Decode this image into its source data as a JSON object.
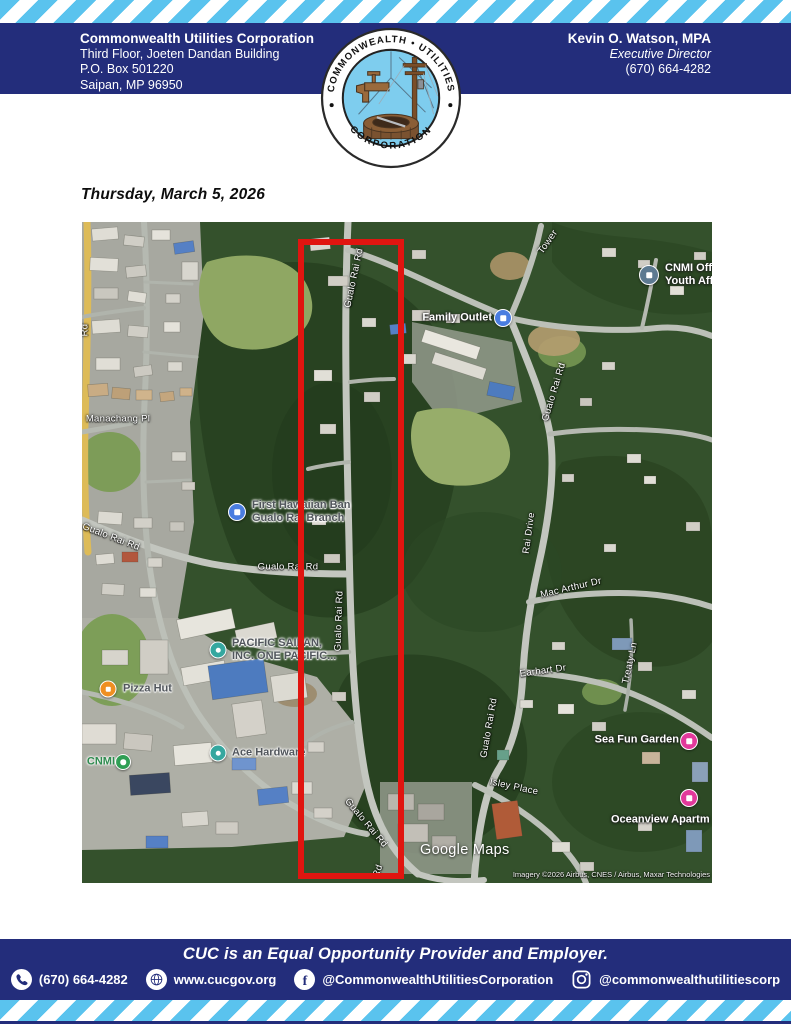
{
  "page": {
    "colors": {
      "navy": "#232d7b",
      "stripe_blue": "#5ac3ee",
      "highlight_red": "#e01510"
    }
  },
  "header": {
    "org_name": "Commonwealth Utilities Corporation",
    "address_lines": [
      "Third Floor, Joeten Dandan Building",
      "P.O. Box 501220",
      "Saipan, MP 96950"
    ],
    "director": {
      "name": "Kevin O. Watson, MPA",
      "title": "Executive Director",
      "phone": "(670) 664-4282"
    }
  },
  "logo": {
    "arc_top": "COMMONWEALTH • UTILITIES",
    "arc_bottom": "CORPORATION"
  },
  "date_line": "Thursday, March 5, 2026",
  "map": {
    "watermark": "Google Maps",
    "attribution": "Imagery ©2026 Airbus, CNES / Airbus, Maxar Technologies",
    "highlight": {
      "x": 216,
      "y": 17,
      "width": 94,
      "height": 628,
      "color": "#e01510"
    },
    "road_labels": [
      {
        "text": "Gualo Rai Rd",
        "x": 272,
        "y": 56,
        "rot": -78
      },
      {
        "text": "Tower",
        "x": 466,
        "y": 20,
        "rot": -55
      },
      {
        "text": "Gualo Rai Rd",
        "x": 472,
        "y": 170,
        "rot": -73
      },
      {
        "text": "Manachang Pl",
        "x": 36,
        "y": 197,
        "rot": 0
      },
      {
        "text": "Gualo Rai Rd",
        "x": 29,
        "y": 315,
        "rot": 21
      },
      {
        "text": "Gualo Rai Rd",
        "x": 206,
        "y": 345,
        "rot": 0
      },
      {
        "text": "Rai Drive",
        "x": 447,
        "y": 311,
        "rot": -82
      },
      {
        "text": "Mac Arthur Dr",
        "x": 489,
        "y": 366,
        "rot": -13
      },
      {
        "text": "Gualo Rai Rd",
        "x": 257,
        "y": 399,
        "rot": -88
      },
      {
        "text": "Earhart Dr",
        "x": 461,
        "y": 449,
        "rot": -8
      },
      {
        "text": "Treaty Ln",
        "x": 548,
        "y": 441,
        "rot": -78
      },
      {
        "text": "Gualo Rai Rd",
        "x": 407,
        "y": 506,
        "rot": -80
      },
      {
        "text": "Isley Place",
        "x": 432,
        "y": 565,
        "rot": 12
      },
      {
        "text": "Gualo Rai Rd",
        "x": 284,
        "y": 601,
        "rot": 50
      },
      {
        "text": "Rd",
        "x": 296,
        "y": 649,
        "rot": -70
      },
      {
        "text": "Rd",
        "x": 3,
        "y": 108,
        "rot": -90
      }
    ],
    "pois": [
      {
        "name": "Family Outlet",
        "lines": [
          "Family Outlet"
        ],
        "style": "light",
        "icon": {
          "x": 421,
          "y": 96,
          "color": "#4a7de0",
          "size": 16,
          "glyph": "square"
        },
        "label": {
          "x": 410,
          "y": 96,
          "align": "right"
        }
      },
      {
        "name": "CNMI Office Youth Affairs",
        "lines": [
          "CNMI Offi",
          "Youth Aff"
        ],
        "style": "light",
        "icon": {
          "x": 567,
          "y": 53,
          "color": "#5d7a91",
          "size": 18,
          "glyph": "square"
        },
        "label": {
          "x": 583,
          "y": 53,
          "align": "left"
        }
      },
      {
        "name": "First Hawaiian Bank Gualo Rai Branch",
        "lines": [
          "First Hawaiian Ban",
          "Gualo Rai Branch"
        ],
        "style": "dark",
        "icon": {
          "x": 155,
          "y": 290,
          "color": "#4a7de0",
          "size": 16,
          "glyph": "square"
        },
        "label": {
          "x": 170,
          "y": 290,
          "align": "left"
        }
      },
      {
        "name": "Pacific Saipan Inc One Pacific",
        "lines": [
          "PACIFIC SAIPAN,",
          "INC. ONE PACIFIC..."
        ],
        "style": "dark",
        "icon": {
          "x": 136,
          "y": 428,
          "color": "#35a79f",
          "size": 15,
          "glyph": "round"
        },
        "label": {
          "x": 150,
          "y": 428,
          "align": "left"
        }
      },
      {
        "name": "Pizza Hut",
        "lines": [
          "Pizza Hut"
        ],
        "style": "dark",
        "icon": {
          "x": 26,
          "y": 467,
          "color": "#ef8f22",
          "size": 15,
          "glyph": "square"
        },
        "label": {
          "x": 41,
          "y": 467,
          "align": "left"
        }
      },
      {
        "name": "Ace Hardware",
        "lines": [
          "Ace Hardware"
        ],
        "style": "dark",
        "icon": {
          "x": 136,
          "y": 531,
          "color": "#35a79f",
          "size": 15,
          "glyph": "round"
        },
        "label": {
          "x": 150,
          "y": 531,
          "align": "left"
        }
      },
      {
        "name": "CNMI",
        "lines": [
          "CNMI"
        ],
        "style": "green",
        "icon": {
          "x": 41,
          "y": 540,
          "color": "#2f9e54",
          "size": 14,
          "glyph": "round"
        },
        "label": {
          "x": 33,
          "y": 540,
          "align": "right"
        }
      },
      {
        "name": "Sea Fun Garden",
        "lines": [
          "Sea Fun Garden"
        ],
        "style": "light",
        "icon": {
          "x": 607,
          "y": 519,
          "color": "#e2399b",
          "size": 16,
          "glyph": "square"
        },
        "label": {
          "x": 597,
          "y": 518,
          "align": "right"
        }
      },
      {
        "name": "Oceanview Apartments",
        "lines": [
          "Oceanview Apartm"
        ],
        "style": "light",
        "icon": {
          "x": 607,
          "y": 576,
          "color": "#e2399b",
          "size": 16,
          "glyph": "square"
        },
        "label": {
          "x": 529,
          "y": 598,
          "align": "left"
        }
      }
    ]
  },
  "footer": {
    "eeo_line": "CUC is an Equal Opportunity Provider and Employer.",
    "phone": "(670) 664-4282",
    "website": "www.cucgov.org",
    "facebook": "@CommonwealthUtilitiesCorporation",
    "instagram": "@commonwealthutilitiescorp"
  }
}
